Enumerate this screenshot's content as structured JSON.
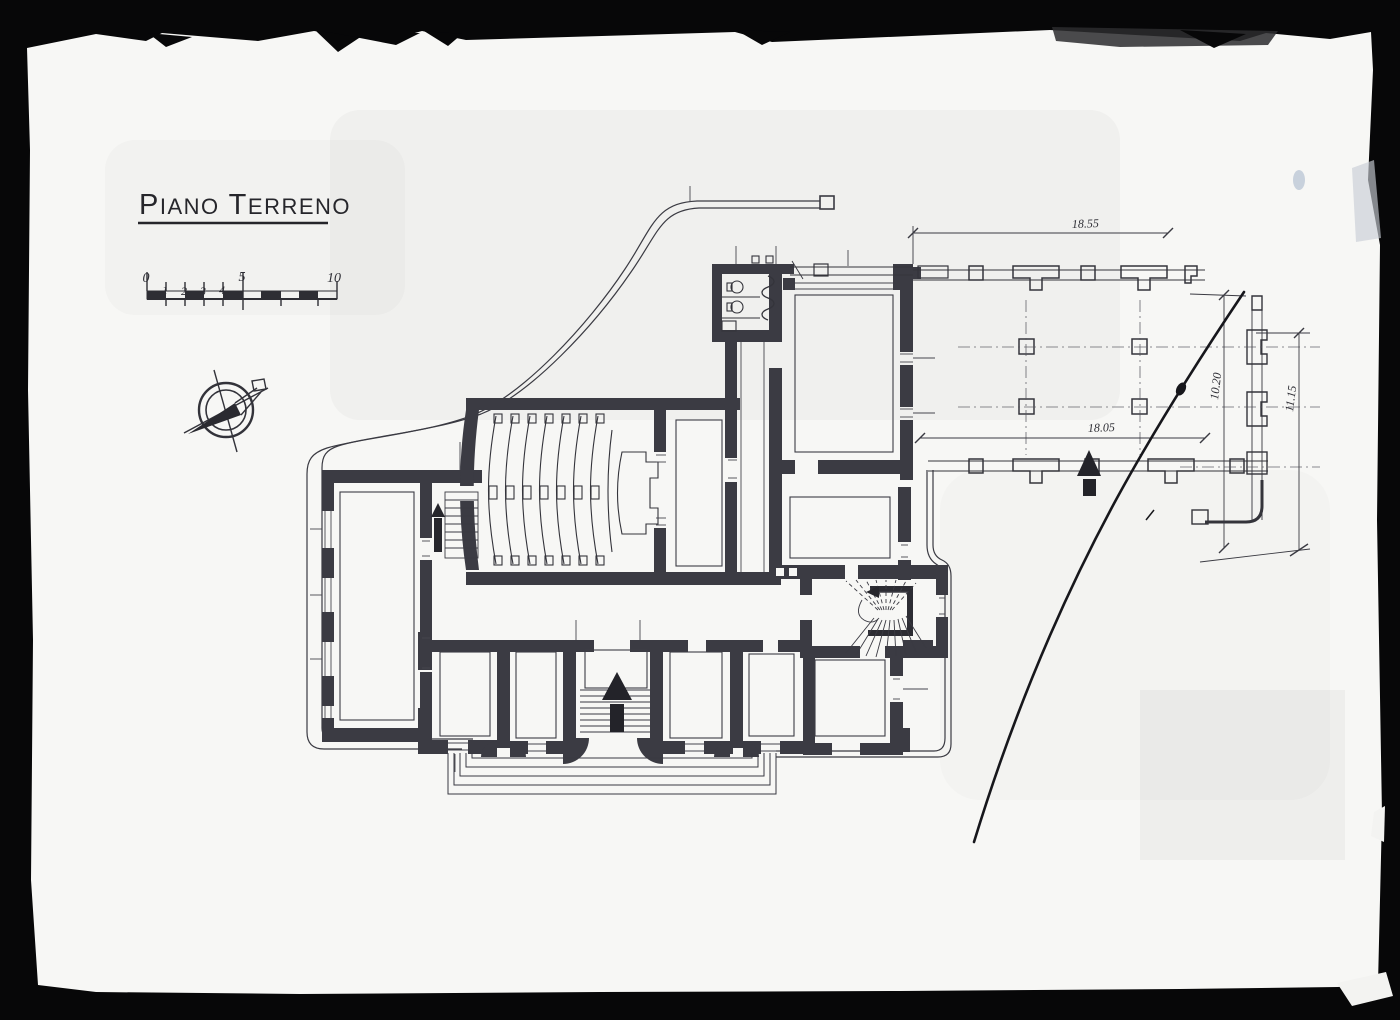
{
  "photo": {
    "description": "archival photograph of an architectural ground floor plan drawing",
    "frame_color": "#070708",
    "paper_color": "#f7f7f5",
    "ink_color": "#2e2e34"
  },
  "plan": {
    "title": {
      "p1": "P",
      "p2": "IANO",
      "p3": " T",
      "p4": "ERRENO"
    },
    "scale_bar": {
      "labels": [
        "0",
        "1",
        "2",
        "3",
        "4",
        "5",
        "10"
      ]
    },
    "dimensions": {
      "portico_top": "18.55",
      "portico_inner": "18.05",
      "portico_depth": "10.20",
      "pergola_side": "11.15"
    }
  }
}
